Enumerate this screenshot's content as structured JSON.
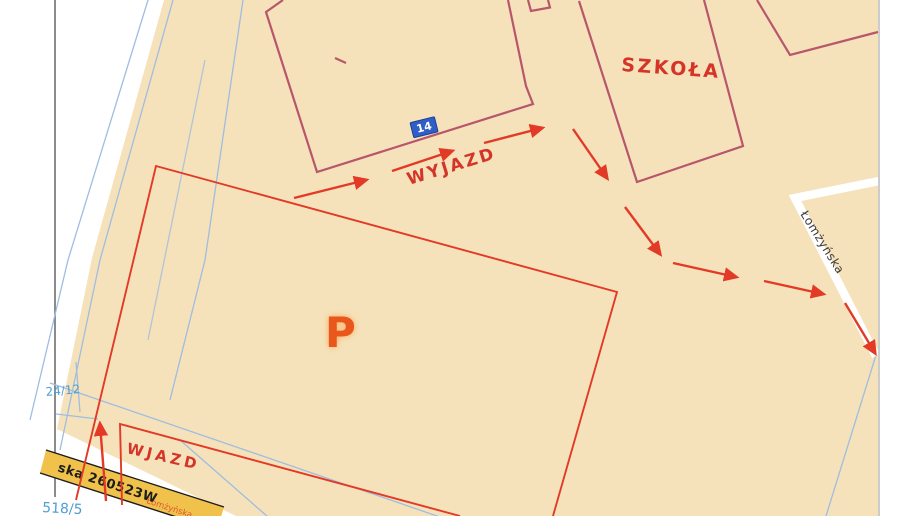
{
  "map": {
    "labels": {
      "school": "SZKOŁA",
      "exit_route": "WYJAZD",
      "entrance": "WJAZD",
      "parking_symbol": "P",
      "street_name": "Łomżyńska",
      "building_number": "14",
      "road_band_text": "ska 260523W",
      "road_band_street": "Łomżyńska",
      "parcel_number_upper": "24/12",
      "parcel_number_lower": "518/5"
    },
    "colors": {
      "paper": "#f5e2bb",
      "building_outline": "#b8566b",
      "route_red": "#e23a26",
      "label_red": "#d43528",
      "survey_blue": "#9fbde0",
      "marker_blue": "#2f5ec6",
      "band_yellow": "#f1c24b",
      "band_edge": "#1c1c1c",
      "parcel_blue": "#4e9fd4",
      "street_text": "#3c3c3c",
      "scan_edge": "#555555",
      "margin_edge": "#bbbbbb",
      "road_white": "#ffffff",
      "parking_p": "#e9571c",
      "parking_p_halo": "#ffa14e"
    }
  }
}
